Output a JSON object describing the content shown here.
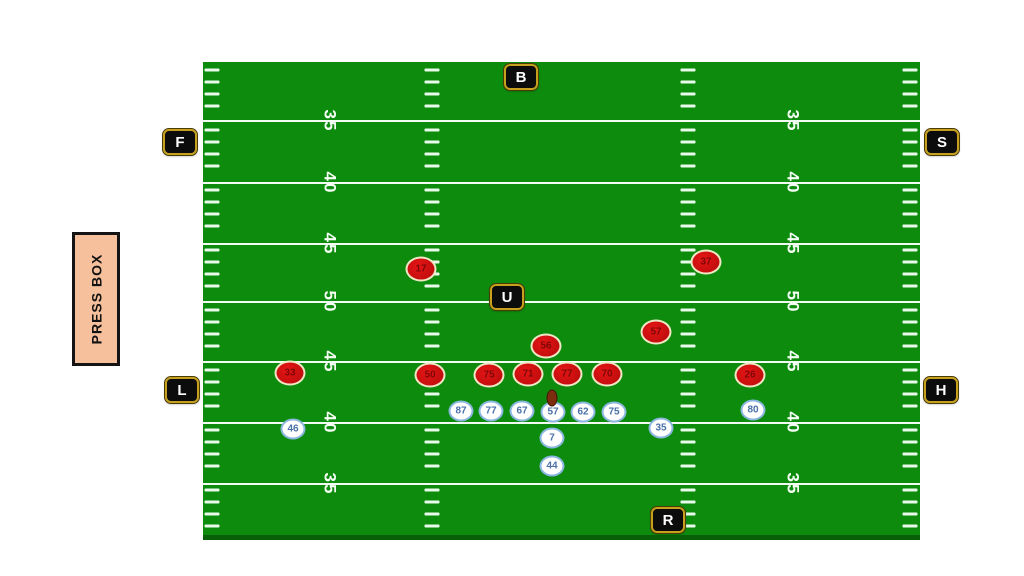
{
  "press_box": {
    "label": "PRESS BOX"
  },
  "field": {
    "yard_lines_y": [
      58,
      120,
      181,
      239,
      299,
      360,
      421
    ],
    "yard_numbers": [
      "35",
      "40",
      "45",
      "50",
      "45",
      "40",
      "35"
    ],
    "number_columns_x": [
      127,
      590
    ],
    "hash_columns_x": [
      9,
      229,
      485,
      707
    ],
    "colors": {
      "turf": "#0d8b0d",
      "lines": "#f2fcf2",
      "bottom_edge": "#076007"
    }
  },
  "officials": {
    "colors": {
      "bg": "#0c0c0c",
      "border": "#c7a11d",
      "text": "#ffffff"
    },
    "items": [
      {
        "label": "B",
        "x": 521,
        "y": 77
      },
      {
        "label": "F",
        "x": 180,
        "y": 142
      },
      {
        "label": "S",
        "x": 942,
        "y": 142
      },
      {
        "label": "U",
        "x": 507,
        "y": 297
      },
      {
        "label": "L",
        "x": 182,
        "y": 390
      },
      {
        "label": "H",
        "x": 941,
        "y": 390
      },
      {
        "label": "R",
        "x": 668,
        "y": 520
      }
    ]
  },
  "defense": {
    "fill_color": "#c50f0f",
    "number_color": "#7e0707",
    "players": [
      {
        "number": "17",
        "x": 421,
        "y": 269
      },
      {
        "number": "37",
        "x": 706,
        "y": 262
      },
      {
        "number": "56",
        "x": 546,
        "y": 346
      },
      {
        "number": "57",
        "x": 656,
        "y": 332
      },
      {
        "number": "33",
        "x": 290,
        "y": 373
      },
      {
        "number": "50",
        "x": 430,
        "y": 375
      },
      {
        "number": "75",
        "x": 489,
        "y": 375
      },
      {
        "number": "71",
        "x": 528,
        "y": 374
      },
      {
        "number": "77",
        "x": 567,
        "y": 374
      },
      {
        "number": "70",
        "x": 607,
        "y": 374
      },
      {
        "number": "26",
        "x": 750,
        "y": 375
      }
    ]
  },
  "offense": {
    "ring_color": "#8ab6de",
    "number_color": "#4a70a8",
    "players": [
      {
        "number": "46",
        "x": 293,
        "y": 429
      },
      {
        "number": "87",
        "x": 461,
        "y": 411
      },
      {
        "number": "77",
        "x": 491,
        "y": 411
      },
      {
        "number": "67",
        "x": 522,
        "y": 411
      },
      {
        "number": "57",
        "x": 553,
        "y": 412
      },
      {
        "number": "62",
        "x": 583,
        "y": 412
      },
      {
        "number": "75",
        "x": 614,
        "y": 412
      },
      {
        "number": "35",
        "x": 661,
        "y": 428
      },
      {
        "number": "80",
        "x": 753,
        "y": 410
      },
      {
        "number": "7",
        "x": 552,
        "y": 438
      },
      {
        "number": "44",
        "x": 552,
        "y": 466
      }
    ]
  },
  "football": {
    "x": 552,
    "y": 398,
    "color": "#7c2d0e"
  }
}
